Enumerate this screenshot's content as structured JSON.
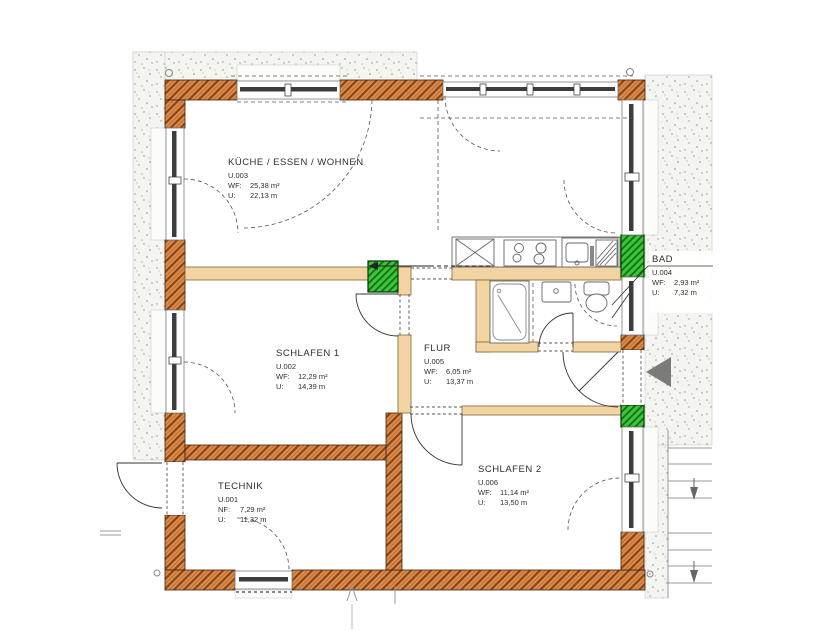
{
  "plan": {
    "rooms": [
      {
        "name": "KÜCHE / ESSEN / WOHNEN",
        "id": "U.003",
        "area_label": "WF:",
        "area": "25,38 m²",
        "peri_label": "U:",
        "peri": "22,13 m"
      },
      {
        "name": "SCHLAFEN 1",
        "id": "U.002",
        "area_label": "WF:",
        "area": "12,29 m²",
        "peri_label": "U:",
        "peri": "14,39 m"
      },
      {
        "name": "FLUR",
        "id": "U.005",
        "area_label": "WF:",
        "area": "6,05 m²",
        "peri_label": "U:",
        "peri": "13,37 m"
      },
      {
        "name": "BAD",
        "id": "U.004",
        "area_label": "WF:",
        "area": "2,93 m²",
        "peri_label": "U:",
        "peri": "7,32 m"
      },
      {
        "name": "TECHNIK",
        "id": "U.001",
        "area_label": "NF:",
        "area": "7,29 m²",
        "peri_label": "U:",
        "peri": "11,32 m"
      },
      {
        "name": "SCHLAFEN 2",
        "id": "U.006",
        "area_label": "WF:",
        "area": "11,14 m²",
        "peri_label": "U:",
        "peri": "13,50 m"
      }
    ],
    "colors": {
      "exterior_wall": "#db8e4f",
      "wall_hatch": "#8a4516",
      "partition_wall": "#f2d4a2",
      "vent_shaft_green": "#3ec43e",
      "ground_dots": "#8f8f8b",
      "entrance_arrow": "#7b7b78"
    }
  }
}
